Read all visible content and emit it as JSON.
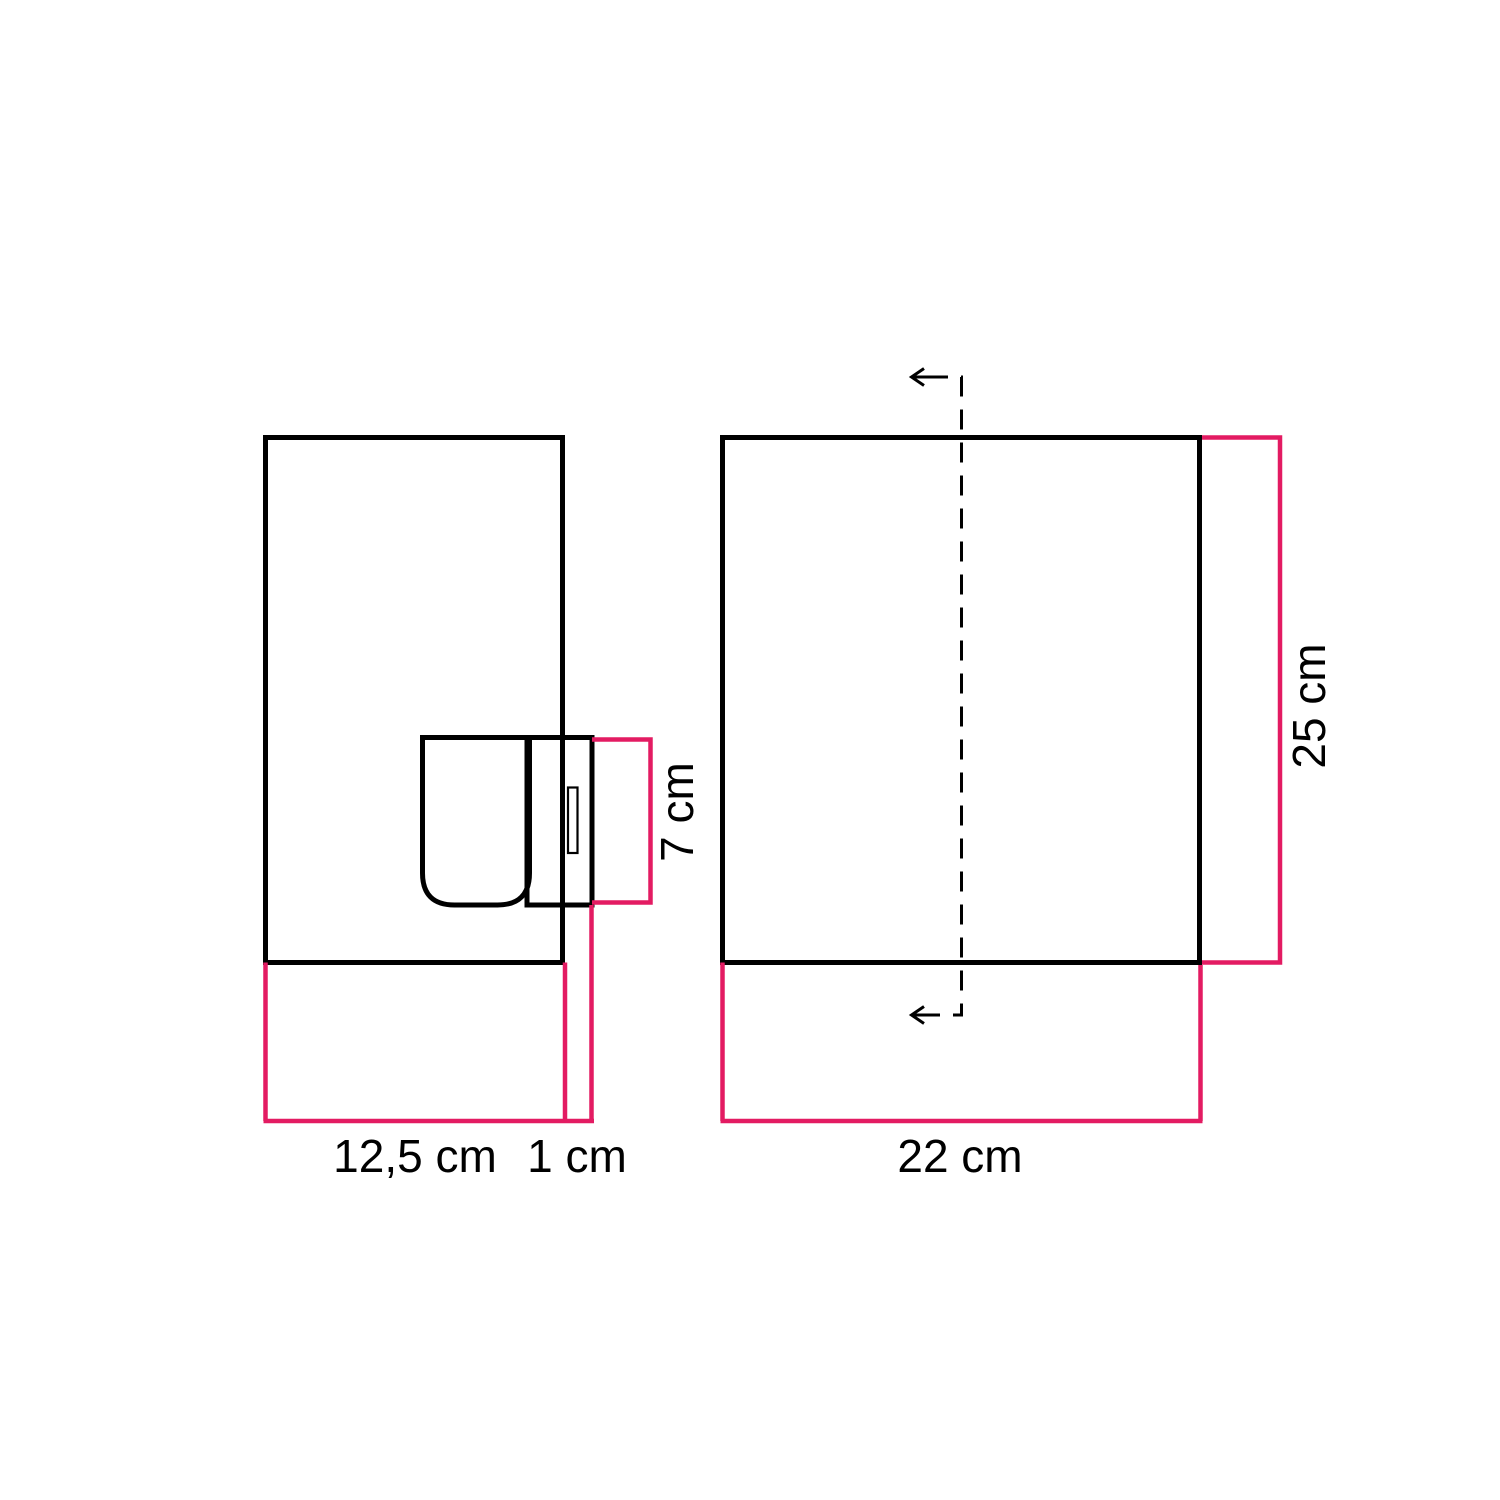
{
  "colors": {
    "background": "#ffffff",
    "outline": "#000000",
    "accent": "#e31b62"
  },
  "diagram": {
    "side_view": {
      "width_label": "12,5 cm",
      "overhang_label": "1 cm",
      "socket_height_label": "7 cm"
    },
    "front_view": {
      "width_label": "22 cm",
      "height_label": "25 cm"
    }
  }
}
